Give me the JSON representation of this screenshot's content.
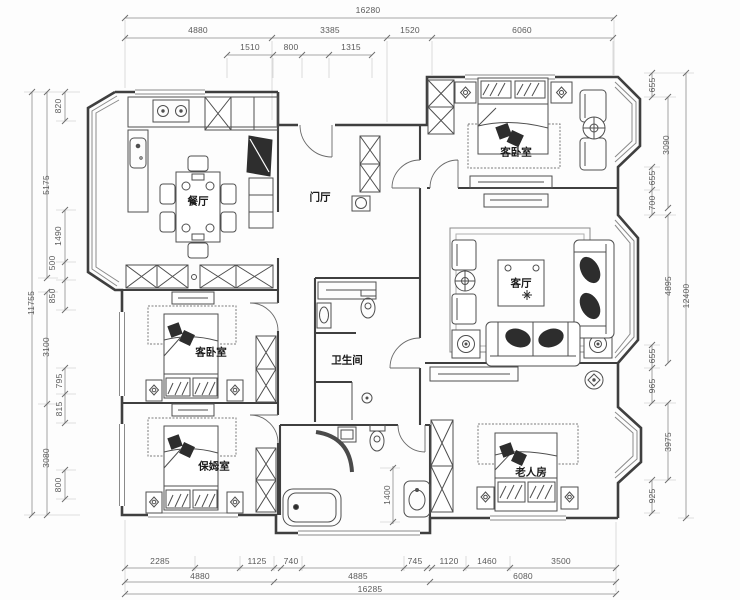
{
  "rooms": {
    "dining": "餐厅",
    "foyer": "门厅",
    "guest_bedroom_top": "客卧室",
    "living": "客厅",
    "guest_bedroom_left": "客卧室",
    "nanny": "保姆室",
    "bathroom": "卫生间",
    "elderly": "老人房"
  },
  "dimensions": {
    "top": {
      "overall": "16280",
      "row2": [
        "4880",
        "3385",
        "1520",
        "6060"
      ],
      "row3": [
        "1510",
        "800",
        "1315"
      ]
    },
    "bottom": {
      "row1": [
        "2285",
        "1125",
        "740",
        "745",
        "1120",
        "1460",
        "3500"
      ],
      "row2": [
        "4880",
        "4885",
        "6080"
      ],
      "overall": "16285"
    },
    "left": {
      "overall": "11755",
      "dims": [
        "820",
        "5175",
        "1490",
        "500",
        "850",
        "3100",
        "795",
        "815",
        "3080",
        "800"
      ]
    },
    "right": {
      "overall": "12400",
      "dims": [
        "655",
        "3090",
        "655",
        "700",
        "4895",
        "655",
        "965",
        "3975",
        "925"
      ]
    },
    "interior": {
      "bath_width": "1400"
    }
  },
  "colors": {
    "wall": "#3f3f3f",
    "furniture": "#4f4f4f",
    "dimension": "#8c8c8c",
    "dim_text": "#5a5a5a",
    "room_text": "#1a1a1a",
    "background": "#ffffff"
  }
}
